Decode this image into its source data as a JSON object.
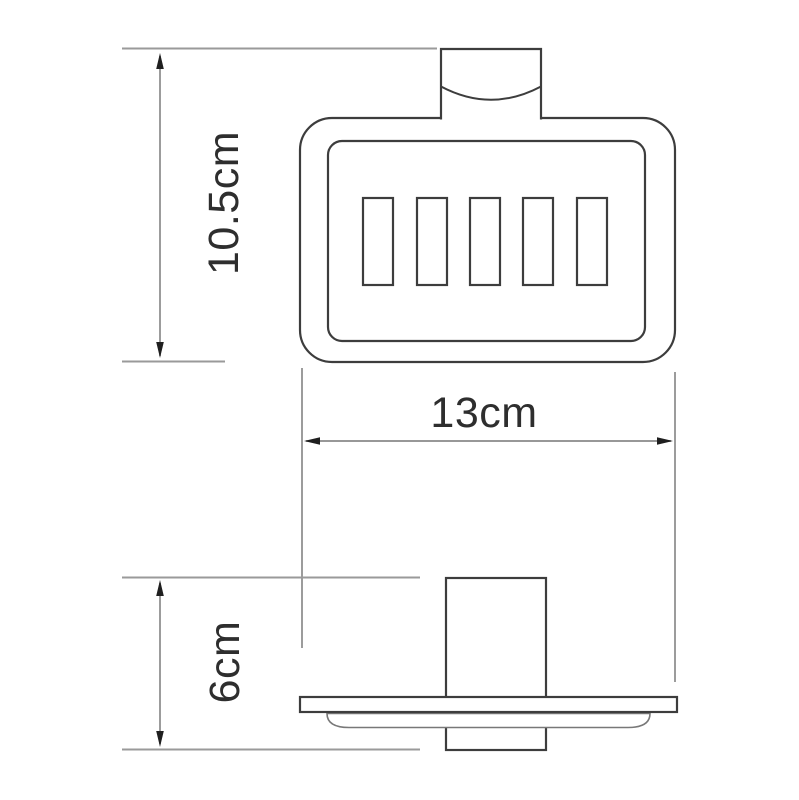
{
  "drawing": {
    "subject": "wall-mounted-soap-dish-holder",
    "views": {
      "front": {
        "slot_count": 5
      },
      "side": {
        "parts": [
          "wall-post",
          "shelf-plate",
          "dish-bulge"
        ]
      }
    },
    "dimensions": {
      "height": "10.5cm",
      "width": "13cm",
      "depth": "6cm"
    },
    "colors": {
      "background": "#ffffff",
      "outline": "#3d3d3d",
      "dimension_line": "#8a8a8a",
      "extension_line": "#9a9a9a",
      "arrowhead": "#1f1f1f",
      "label_text": "#2e2e2e"
    }
  }
}
